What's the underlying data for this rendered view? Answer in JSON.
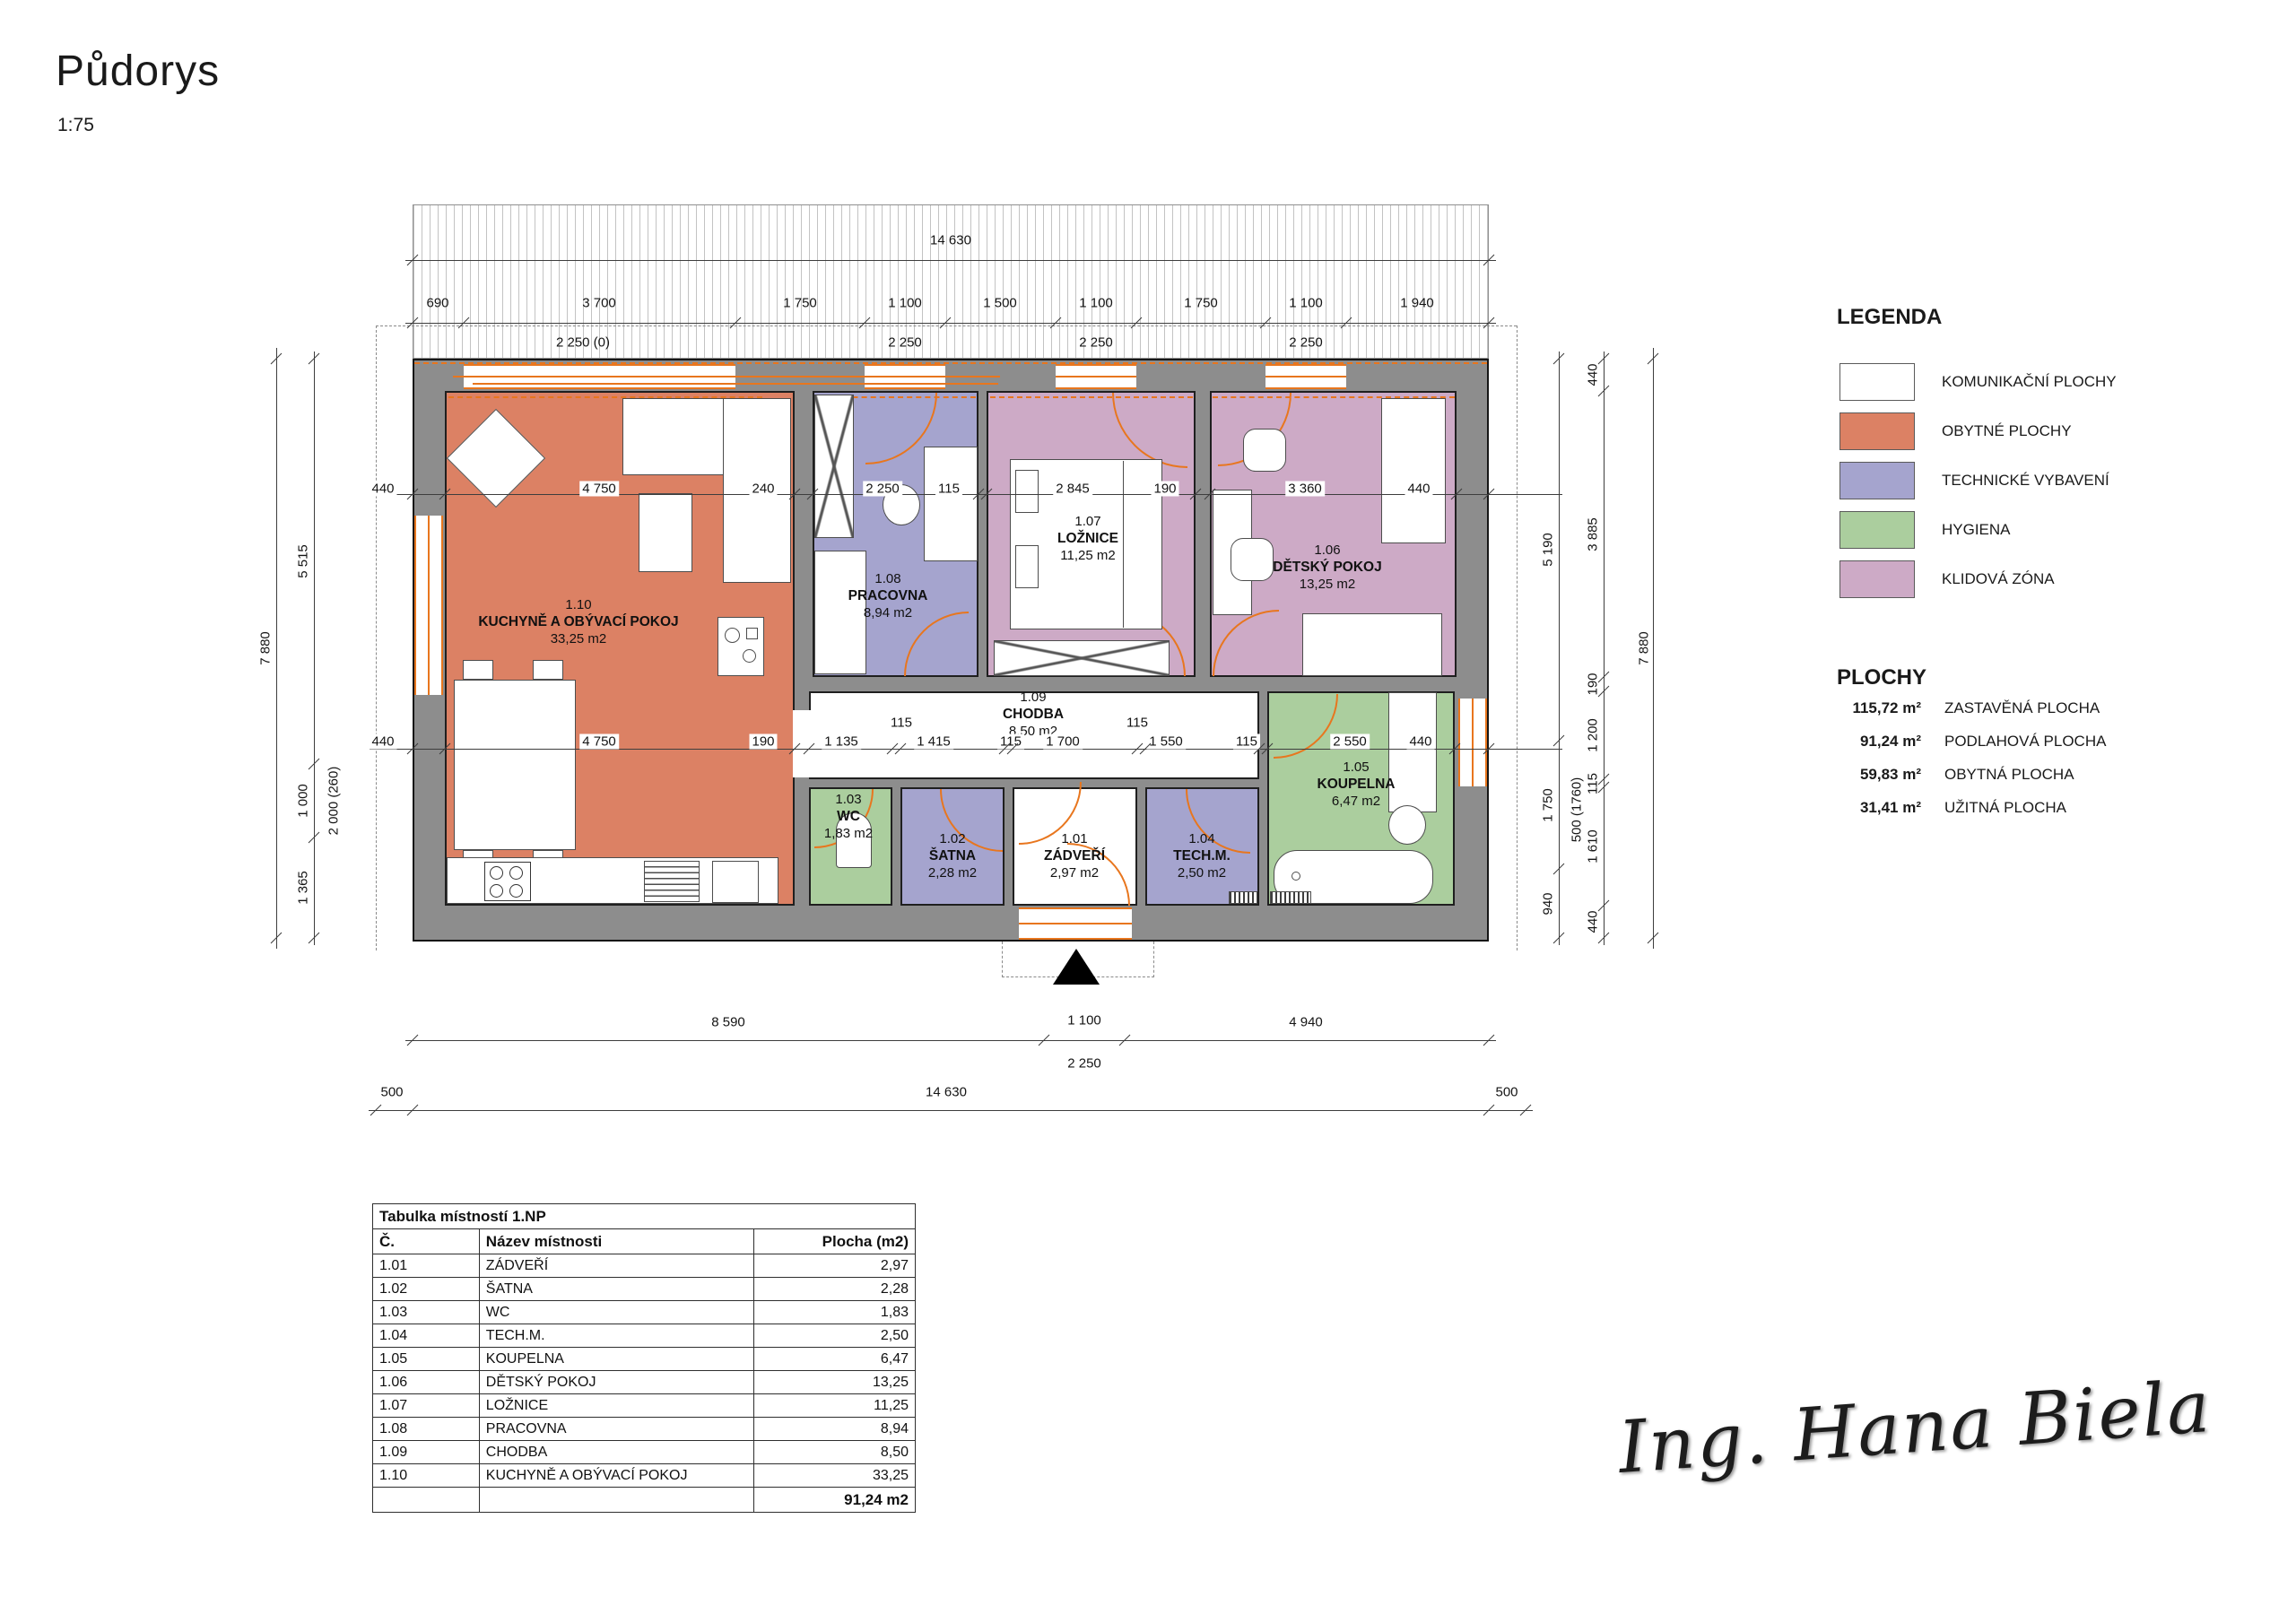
{
  "page": {
    "title": "Půdorys",
    "scale": "1:75"
  },
  "legend": {
    "title": "LEGENDA",
    "items": [
      {
        "label": "KOMUNIKAČNÍ PLOCHY",
        "color": "#ffffff"
      },
      {
        "label": "OBYTNÉ PLOCHY",
        "color": "#dc8164"
      },
      {
        "label": "TECHNICKÉ VYBAVENÍ",
        "color": "#a5a4ce"
      },
      {
        "label": "HYGIENA",
        "color": "#abce9e"
      },
      {
        "label": "KLIDOVÁ ZÓNA",
        "color": "#cdaac6"
      }
    ]
  },
  "areas": {
    "title": "PLOCHY",
    "items": [
      {
        "value": "115,72 m²",
        "label": "ZASTAVĚNÁ PLOCHA"
      },
      {
        "value": "91,24 m²",
        "label": "PODLAHOVÁ PLOCHA"
      },
      {
        "value": "59,83 m²",
        "label": "OBYTNÁ PLOCHA"
      },
      {
        "value": "31,41 m²",
        "label": "UŽITNÁ PLOCHA"
      }
    ]
  },
  "rooms": [
    {
      "id": "r110",
      "number": "1.10",
      "name": "KUCHYNĚ A OBÝVACÍ POKOJ",
      "area": "33,25 m2",
      "color": "#dc8164"
    },
    {
      "id": "r108",
      "number": "1.08",
      "name": "PRACOVNA",
      "area": "8,94 m2",
      "color": "#a5a4ce"
    },
    {
      "id": "r107",
      "number": "1.07",
      "name": "LOŽNICE",
      "area": "11,25 m2",
      "color": "#cdaac6"
    },
    {
      "id": "r106",
      "number": "1.06",
      "name": "DĚTSKÝ POKOJ",
      "area": "13,25 m2",
      "color": "#cdaac6"
    },
    {
      "id": "r109",
      "number": "1.09",
      "name": "CHODBA",
      "area": "8,50 m2",
      "color": "#ffffff"
    },
    {
      "id": "r103",
      "number": "1.03",
      "name": "WC",
      "area": "1,83 m2",
      "color": "#abce9e"
    },
    {
      "id": "r102",
      "number": "1.02",
      "name": "ŠATNA",
      "area": "2,28 m2",
      "color": "#a5a4ce"
    },
    {
      "id": "r101",
      "number": "1.01",
      "name": "ZÁDVEŘÍ",
      "area": "2,97 m2",
      "color": "#ffffff"
    },
    {
      "id": "r104",
      "number": "1.04",
      "name": "TECH.M.",
      "area": "2,50 m2",
      "color": "#a5a4ce"
    },
    {
      "id": "r105",
      "number": "1.05",
      "name": "KOUPELNA",
      "area": "6,47 m2",
      "color": "#abce9e"
    }
  ],
  "dims": {
    "top_total": "14 630",
    "top_row": [
      "690",
      "3 700",
      "1 750",
      "1 100",
      "1 500",
      "1 100",
      "1 750",
      "1 100",
      "1 940"
    ],
    "top_sub": [
      "2 250 (0)",
      "2 250",
      "2 250",
      "2 250"
    ],
    "mid_row": [
      "440",
      "4 750",
      "240",
      "2 250",
      "115",
      "2 845",
      "190",
      "3 360",
      "440"
    ],
    "chodba_row": [
      "440",
      "4 750",
      "190",
      "1 135",
      "1 415",
      "115",
      "1 700",
      "1 550",
      "115",
      "2 550",
      "440"
    ],
    "chodba_115": [
      "115",
      "115"
    ],
    "bottom_row": [
      "8 590",
      "1 100",
      "4 940"
    ],
    "bottom_sub": "2 250",
    "bottom_total": [
      "500",
      "14 630",
      "500"
    ],
    "left_outer": "7 880",
    "left_col": [
      "5 515",
      "1 000",
      "1 365"
    ],
    "left_note": "2 000 (260)",
    "right_inner": [
      "5 190",
      "1 750",
      "940"
    ],
    "right_note": "500 (1760)",
    "right_col": [
      "440",
      "3 885",
      "190",
      "1 200",
      "115",
      "1 610",
      "440"
    ],
    "right_outer": "7 880"
  },
  "table": {
    "title": "Tabulka místností 1.NP",
    "headers": [
      "Č.",
      "Název místnosti",
      "Plocha (m2)"
    ],
    "rows": [
      [
        "1.01",
        "ZÁDVEŘÍ",
        "2,97"
      ],
      [
        "1.02",
        "ŠATNA",
        "2,28"
      ],
      [
        "1.03",
        "WC",
        "1,83"
      ],
      [
        "1.04",
        "TECH.M.",
        "2,50"
      ],
      [
        "1.05",
        "KOUPELNA",
        "6,47"
      ],
      [
        "1.06",
        "DĚTSKÝ POKOJ",
        "13,25"
      ],
      [
        "1.07",
        "LOŽNICE",
        "11,25"
      ],
      [
        "1.08",
        "PRACOVNA",
        "8,94"
      ],
      [
        "1.09",
        "CHODBA",
        "8,50"
      ],
      [
        "1.10",
        "KUCHYNĚ A OBÝVACÍ POKOJ",
        "33,25"
      ]
    ],
    "total": "91,24 m2"
  },
  "signature": "Ing. Hana Biela"
}
